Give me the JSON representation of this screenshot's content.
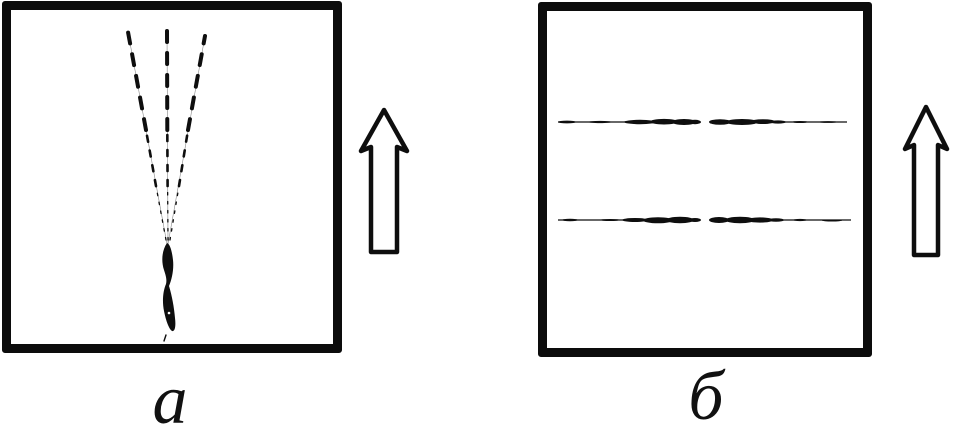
{
  "figure": {
    "background_color": "#ffffff",
    "ink_color": "#0e0e0e",
    "panels": [
      {
        "label": "а",
        "drawing": "dashed-ray-fan-with-crack"
      },
      {
        "label": "б",
        "drawing": "two-horizontal-streaks"
      }
    ],
    "arrows": [
      {
        "icon": "up-arrow-icon",
        "direction": "up"
      },
      {
        "icon": "up-arrow-icon",
        "direction": "up"
      }
    ]
  }
}
